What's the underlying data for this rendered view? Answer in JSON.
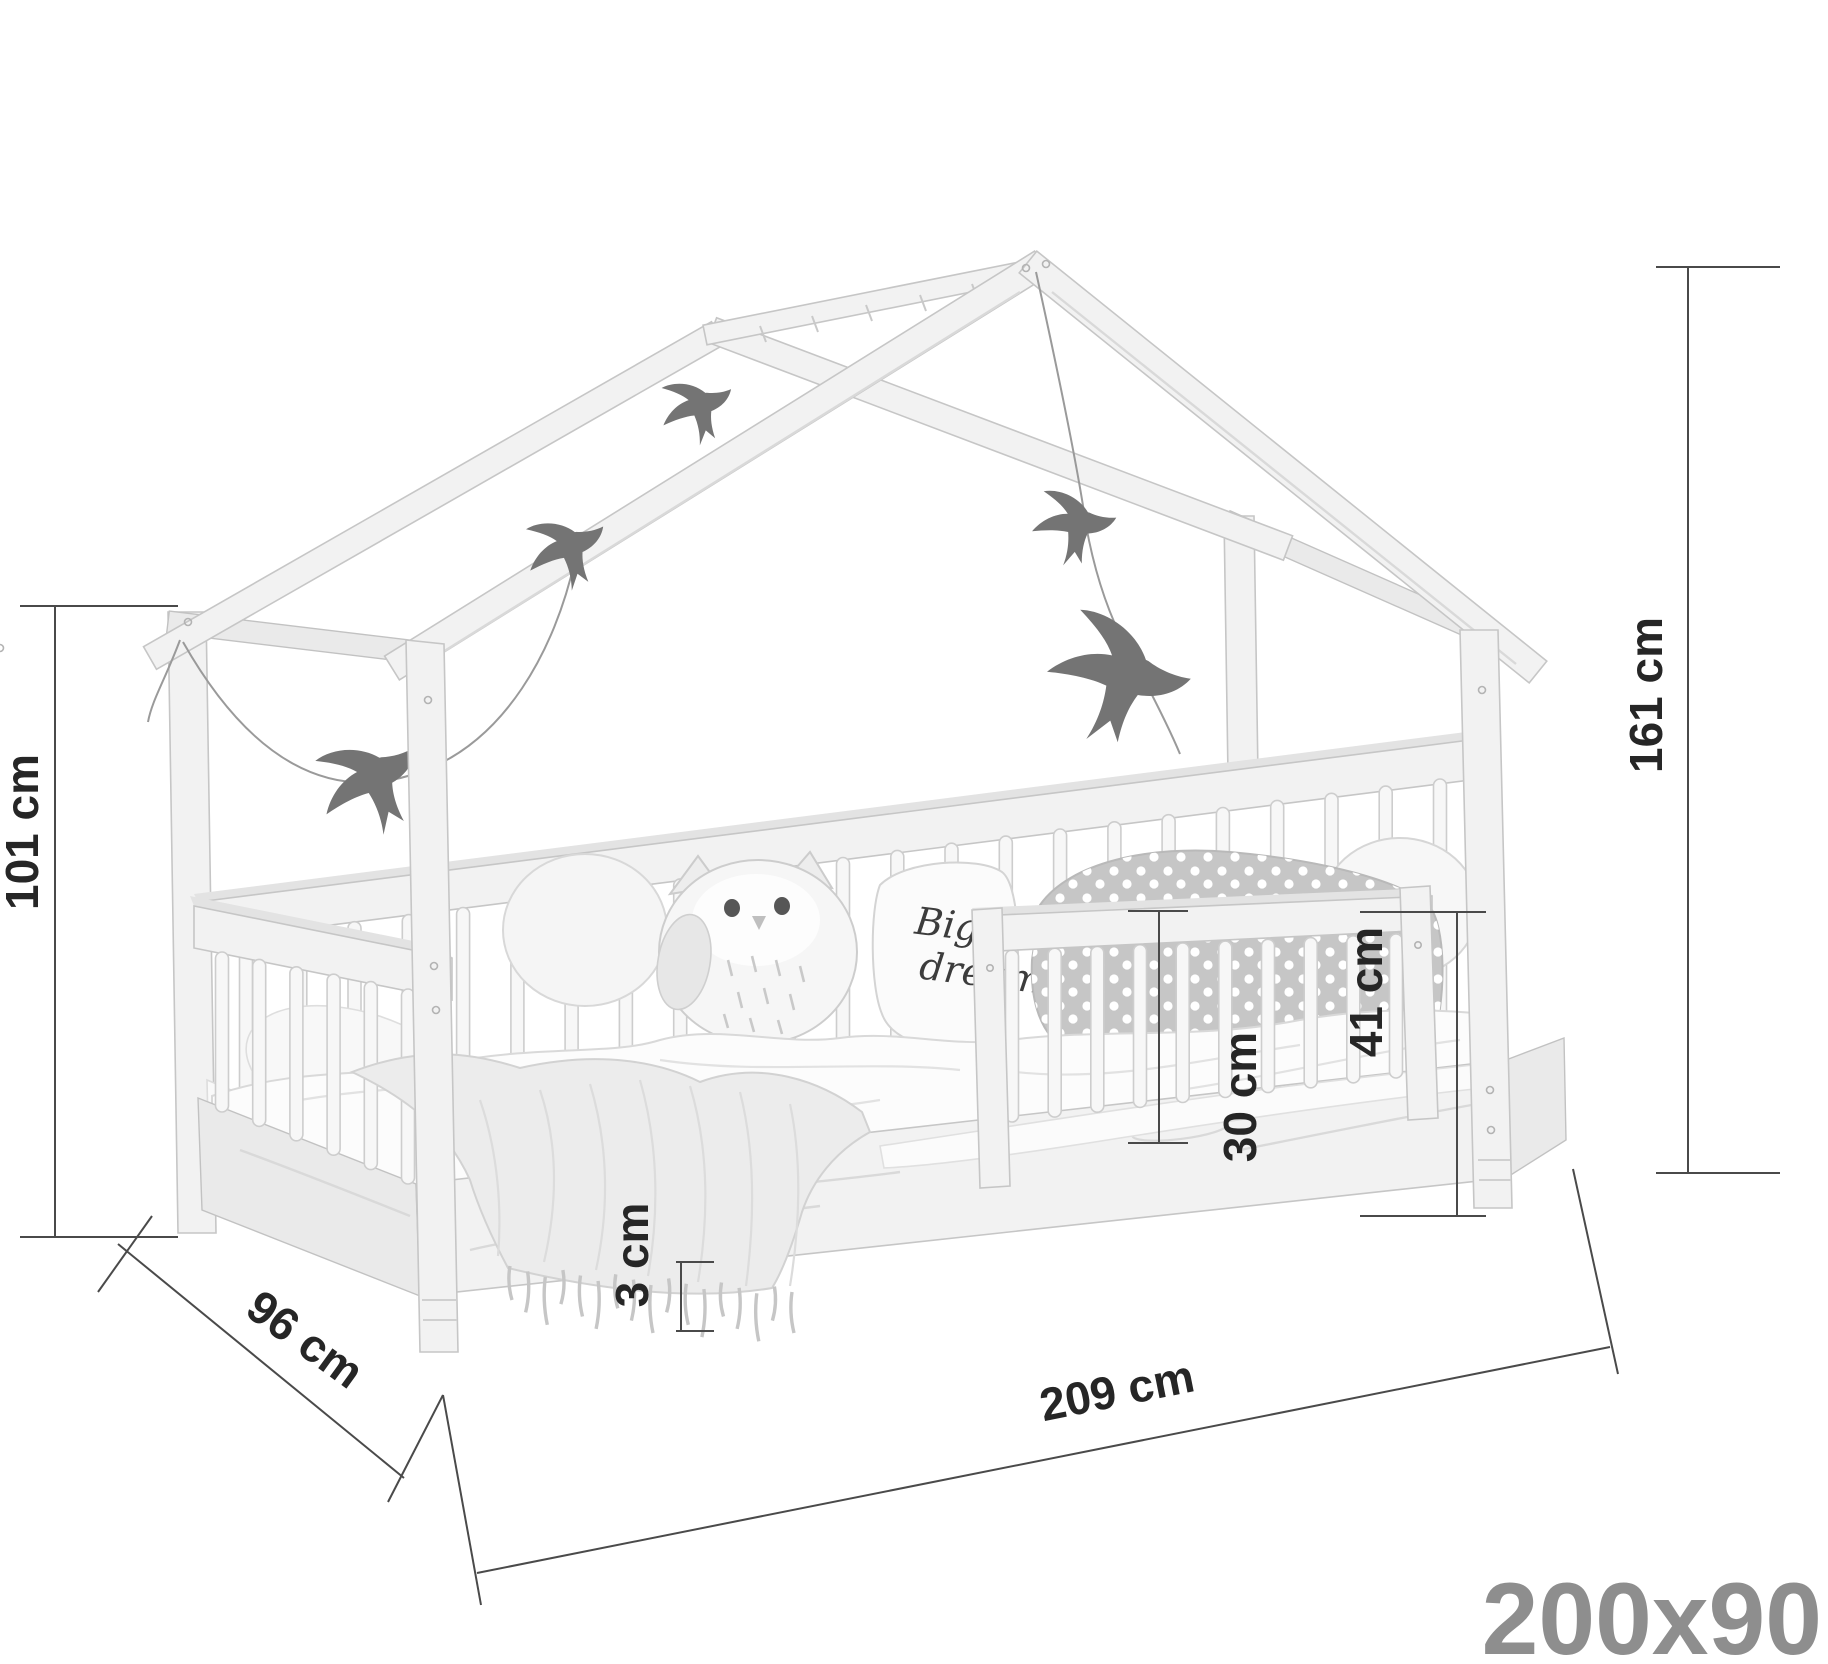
{
  "diagram": {
    "type": "product-dimension-diagram",
    "product": "house bed with guard rail",
    "size_label": "200x90",
    "labels": {
      "post_height": "101 cm",
      "total_height": "161 cm",
      "depth": "96 cm",
      "length": "209 cm",
      "clearance": "3 cm",
      "guard_above_mattress": "30 cm",
      "guard_above_floor": "41 cm",
      "pillow_line1": "Big",
      "pillow_line2": "dreams"
    },
    "colors": {
      "background": "#ffffff",
      "dimension_line": "#4a4a4a",
      "dimension_text": "#262626",
      "size_label_text": "#8e8e8e",
      "wood_fill": "#f2f2f2",
      "wood_outline": "#c6c6c6",
      "bird_silhouette": "#747474",
      "dotted_pillow": "#c6c6c6"
    }
  }
}
